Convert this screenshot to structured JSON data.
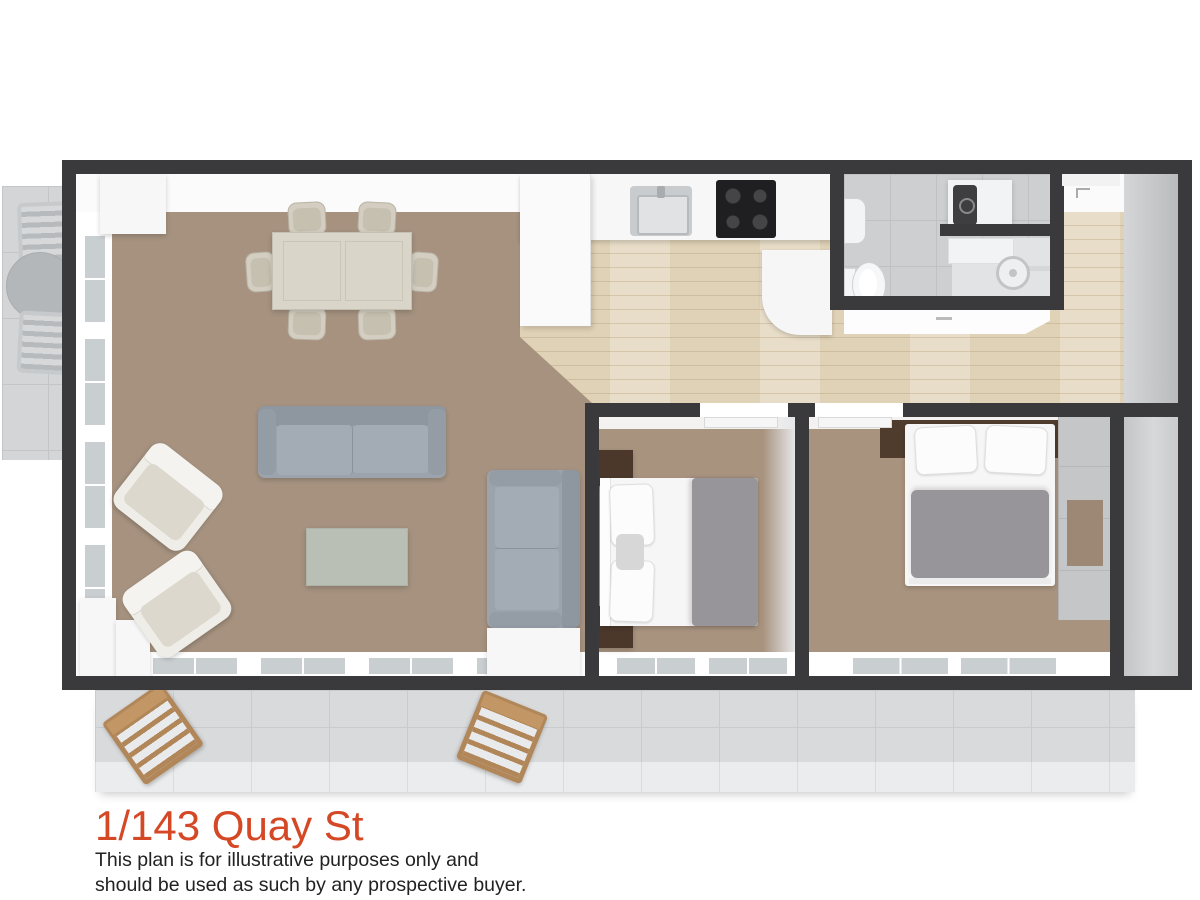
{
  "title": {
    "text": "1/143 Quay St"
  },
  "disclaimer": {
    "line1": "This plan is for illustrative purposes only and",
    "line2": "should be used as such by any prospective buyer."
  },
  "colors": {
    "accent": "#d54826",
    "text": "#222222",
    "wall": "#3a3a3c",
    "carpet": "#a6927f",
    "carpetB": "#a8937f",
    "wood": "#e0d2b6",
    "tileOut": "#d8dadc",
    "tileBath": "#cdcfd0",
    "sofa": "#9ba3ad",
    "duvet": "#97959a",
    "timber": "#b1875a",
    "cream": "#d9d5c9"
  }
}
